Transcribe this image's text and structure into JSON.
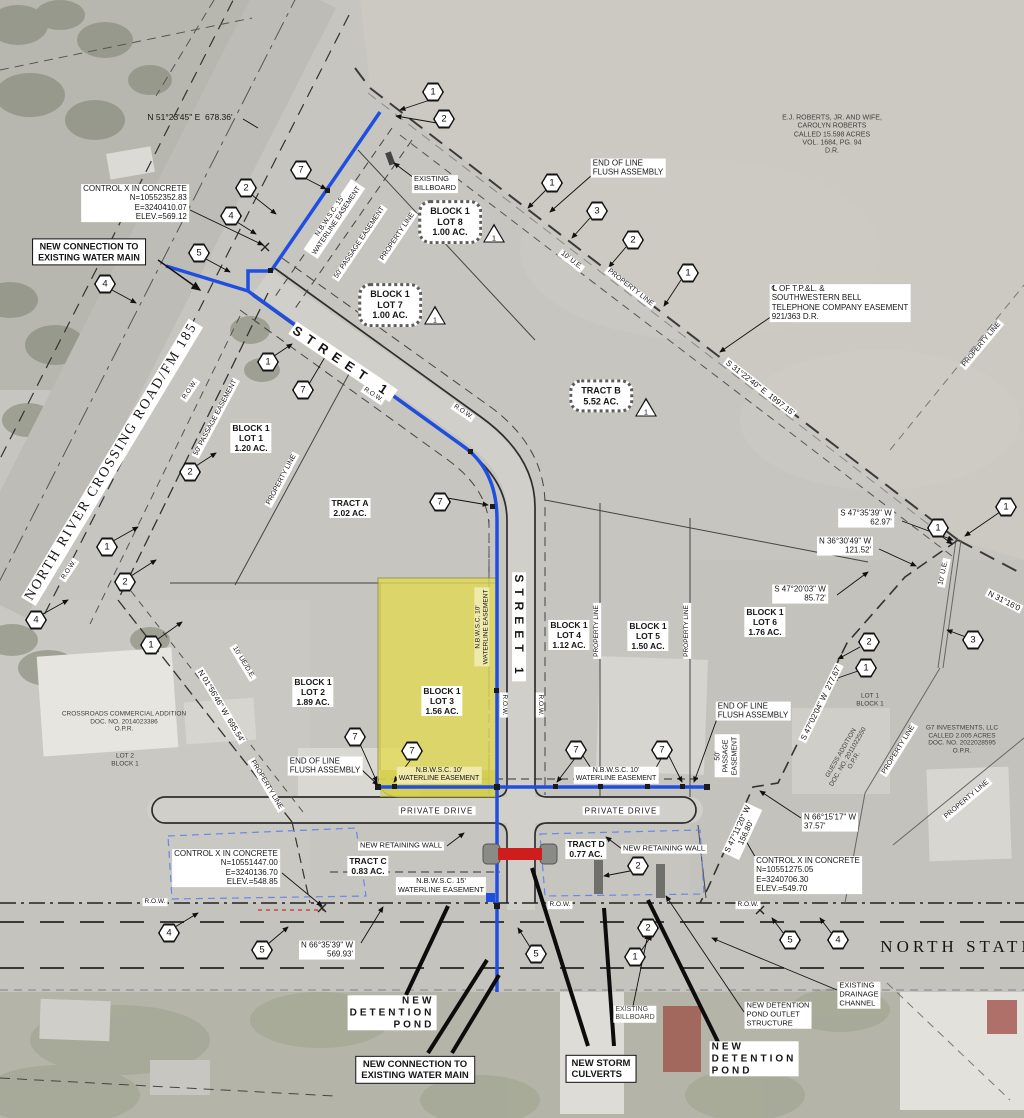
{
  "palette": {
    "waterline_blue": "#1f4fe0",
    "lot_highlight_yellow": "#e3dc52",
    "culvert_red": "#cf1d1d",
    "detention_outline_blue": "#6b86e8"
  },
  "labels": [
    {
      "id": "bearing-n512345",
      "text": "N 51°23'45\" E  678.36'",
      "x": 190,
      "y": 117,
      "fs": 8.5
    },
    {
      "id": "control-x-top",
      "text": "CONTROL X IN CONCRETE\nN=10552352.83\nE=3240410.07\nELEV.=569.12",
      "x": 135,
      "y": 203,
      "cls": "wbg",
      "fs": 8,
      "align": "right"
    },
    {
      "id": "new-connection-top",
      "text": "NEW CONNECTION TO\nEXISTING WATER MAIN",
      "x": 89,
      "y": 252,
      "cls": "boxed",
      "fs": 9
    },
    {
      "id": "nbwsc-15-easement-top",
      "text": "N.B.W.S.C. 15'\nWATERLINE EASEMENT",
      "x": 334,
      "y": 219,
      "rot": -56,
      "cls": "wbg",
      "fs": 7
    },
    {
      "id": "passage-easement-top",
      "text": "50' PASSAGE EASEMENT",
      "x": 360,
      "y": 243,
      "rot": -56,
      "cls": "wbg",
      "fs": 7
    },
    {
      "id": "property-line-top",
      "text": "PROPERTY LINE",
      "x": 398,
      "y": 237,
      "rot": -56,
      "cls": "wbg",
      "fs": 7
    },
    {
      "id": "existing-billboard-top",
      "text": "EXISTING\nBILLBOARD",
      "x": 435,
      "y": 184,
      "cls": "wbg",
      "fs": 7.5,
      "align": "left"
    },
    {
      "id": "end-of-line-top",
      "text": "END OF LINE\nFLUSH ASSEMBLY",
      "x": 628,
      "y": 168,
      "cls": "wbg",
      "fs": 8,
      "align": "left"
    },
    {
      "id": "block1-lot8",
      "text": "BLOCK 1\nLOT 8\n1.00 AC.",
      "x": 450,
      "y": 222,
      "cls": "cloud",
      "fs": 9
    },
    {
      "id": "block1-lot7",
      "text": "BLOCK 1\nLOT 7\n1.00 AC.",
      "x": 390,
      "y": 305,
      "cls": "cloud",
      "fs": 9
    },
    {
      "id": "ej-roberts-tract",
      "text": "E.J. ROBERTS, JR. AND WIFE,\nCAROLYN ROBERTS\nCALLED 15.598 ACRES\nVOL. 1684, PG. 94\nD.R.",
      "x": 832,
      "y": 135,
      "cls": "gray",
      "fs": 7
    },
    {
      "id": "tpl-bell-easement",
      "text": "℄ OF T.P.&L. &\nSOUTHWESTERN BELL\nTELEPHONE COMPANY EASEMENT\n921/363 D.R.",
      "x": 840,
      "y": 303,
      "cls": "wbg",
      "fs": 8,
      "align": "left"
    },
    {
      "id": "bearing-s312240",
      "text": "S 31°22'40\" E  1997.15'",
      "x": 760,
      "y": 388,
      "rot": 38,
      "cls": "wbg",
      "fs": 8
    },
    {
      "id": "ue-10-ne",
      "text": "10' U.E.",
      "x": 571,
      "y": 261,
      "rot": 38,
      "cls": "wbg",
      "fs": 7
    },
    {
      "id": "property-line-ne",
      "text": "PROPERTY LINE",
      "x": 630,
      "y": 288,
      "rot": 38,
      "cls": "wbg",
      "fs": 7
    },
    {
      "id": "tract-b",
      "text": "TRACT B\n5.52 AC.",
      "x": 601,
      "y": 396,
      "cls": "cloud",
      "fs": 9
    },
    {
      "id": "street-1-diagonal",
      "text": "STREET 1",
      "x": 343,
      "y": 362,
      "rot": 34,
      "cls": "wbg bold",
      "fs": 13,
      "ls": 7
    },
    {
      "id": "row-nrc-a",
      "text": "R.O.W.",
      "x": 190,
      "y": 390,
      "rot": -56,
      "cls": "wbg",
      "fs": 6.5
    },
    {
      "id": "row-street-a",
      "text": "R.O.W.",
      "x": 373,
      "y": 395,
      "rot": 34,
      "cls": "wbg",
      "fs": 6.5
    },
    {
      "id": "row-street-b",
      "text": "R.O.W.",
      "x": 463,
      "y": 412,
      "rot": 34,
      "cls": "wbg",
      "fs": 6.5
    },
    {
      "id": "property-line-lot1",
      "text": "PROPERTY LINE",
      "x": 282,
      "y": 480,
      "rot": -62,
      "cls": "wbg",
      "fs": 7
    },
    {
      "id": "passage-easement-lot1",
      "text": "50' PASSAGE EASEMENT",
      "x": 216,
      "y": 418,
      "rot": -62,
      "cls": "wbg",
      "fs": 7
    },
    {
      "id": "block1-lot1",
      "text": "BLOCK 1\nLOT 1\n1.20 AC.",
      "x": 251,
      "y": 438,
      "cls": "wbg bold",
      "fs": 8.5
    },
    {
      "id": "tract-a",
      "text": "TRACT A\n2.02 AC.",
      "x": 350,
      "y": 508,
      "cls": "wbg bold",
      "fs": 8.5
    },
    {
      "id": "bearing-s473539",
      "text": "S 47°35'39\" W\n62.97'",
      "x": 866,
      "y": 518,
      "cls": "wbg",
      "fs": 8,
      "align": "right"
    },
    {
      "id": "bearing-n363049",
      "text": "N 36°30'49\" W\n121.52'",
      "x": 845,
      "y": 546,
      "cls": "wbg",
      "fs": 8,
      "align": "right"
    },
    {
      "id": "bearing-s472003",
      "text": "S 47°20'03\" W\n85.72'",
      "x": 800,
      "y": 594,
      "cls": "wbg",
      "fs": 8,
      "align": "right"
    },
    {
      "id": "ue-10-right",
      "text": "10' U.E.",
      "x": 944,
      "y": 573,
      "rot": -78,
      "cls": "wbg",
      "fs": 7
    },
    {
      "id": "bearing-n31160",
      "text": "N 31°16'0",
      "x": 1004,
      "y": 601,
      "rot": 27,
      "cls": "wbg",
      "fs": 8
    },
    {
      "id": "property-line-right-top",
      "text": "PROPERTY LINE",
      "x": 982,
      "y": 345,
      "rot": -50,
      "cls": "wbg",
      "fs": 7
    },
    {
      "id": "row-nrc-b",
      "text": "R.O.W.",
      "x": 69,
      "y": 570,
      "rot": -56,
      "cls": "wbg",
      "fs": 6.5
    },
    {
      "id": "north-river-crossing-road",
      "text": "NORTH RIVER CROSSING ROAD/FM 185",
      "x": 112,
      "y": 462,
      "rot": -59,
      "cls": "wbg serif",
      "fs": 14,
      "ls": 2
    },
    {
      "id": "bearing-n015646",
      "text": "N 01°56'46\" W  695.54'",
      "x": 221,
      "y": 706,
      "rot": 59,
      "cls": "wbg",
      "fs": 8
    },
    {
      "id": "ue-de-10",
      "text": "10' UE/D.E.",
      "x": 243,
      "y": 663,
      "rot": 59,
      "cls": "wbg",
      "fs": 7
    },
    {
      "id": "property-line-sw",
      "text": "PROPERTY LINE",
      "x": 266,
      "y": 785,
      "rot": 59,
      "cls": "wbg",
      "fs": 7
    },
    {
      "id": "crossroads-addition",
      "text": "CROSSROADS COMMERCIAL ADDITION\nDOC. NO. 2014023386\nO.P.R.",
      "x": 124,
      "y": 722,
      "cls": "gray",
      "fs": 6.5
    },
    {
      "id": "lot2-block1-existing",
      "text": "LOT 2\nBLOCK 1",
      "x": 125,
      "y": 760,
      "cls": "gray",
      "fs": 6.5
    },
    {
      "id": "block1-lot2",
      "text": "BLOCK 1\nLOT 2\n1.89 AC.",
      "x": 313,
      "y": 692,
      "cls": "wbg bold",
      "fs": 8.5
    },
    {
      "id": "block1-lot3",
      "text": "BLOCK 1\nLOT 3\n1.56 AC.",
      "x": 442,
      "y": 701,
      "cls": "wbg bold",
      "fs": 8.5
    },
    {
      "id": "nbwsc-10-lot3-vert",
      "text": "N.B.W.S.C. 10'\nWATERLINE EASEMENT",
      "x": 482,
      "y": 627,
      "rot": -90,
      "cls": "pale",
      "fs": 6.5
    },
    {
      "id": "street-1-vertical",
      "text": "STREET 1",
      "x": 519,
      "y": 627,
      "rot": 90,
      "cls": "wbg bold",
      "fs": 12,
      "ls": 6
    },
    {
      "id": "row-street-v1",
      "text": "R.O.W.",
      "x": 504,
      "y": 705,
      "rot": 90,
      "cls": "wbg",
      "fs": 6.5
    },
    {
      "id": "row-street-v2",
      "text": "R.O.W.",
      "x": 540,
      "y": 705,
      "rot": 90,
      "cls": "wbg",
      "fs": 6.5
    },
    {
      "id": "block1-lot4",
      "text": "BLOCK 1\nLOT 4\n1.12 AC.",
      "x": 569,
      "y": 635,
      "cls": "wbg bold",
      "fs": 8.5
    },
    {
      "id": "property-line-v1",
      "text": "PROPERTY LINE",
      "x": 597,
      "y": 631,
      "rot": -90,
      "cls": "wbg",
      "fs": 6.5
    },
    {
      "id": "block1-lot5",
      "text": "BLOCK 1\nLOT 5\n1.50 AC.",
      "x": 648,
      "y": 636,
      "cls": "wbg bold",
      "fs": 8.5
    },
    {
      "id": "property-line-v2",
      "text": "PROPERTY LINE",
      "x": 687,
      "y": 631,
      "rot": -90,
      "cls": "wbg",
      "fs": 6.5
    },
    {
      "id": "block1-lot6",
      "text": "BLOCK 1\nLOT 6\n1.76 AC.",
      "x": 765,
      "y": 622,
      "cls": "wbg bold",
      "fs": 8.5
    },
    {
      "id": "bearing-s470204",
      "text": "S 47°02'04\" W  277.67'",
      "x": 821,
      "y": 703,
      "rot": -64,
      "cls": "wbg",
      "fs": 8
    },
    {
      "id": "lot1-block1-existing",
      "text": "LOT 1\nBLOCK 1",
      "x": 870,
      "y": 700,
      "cls": "gray",
      "fs": 6.5
    },
    {
      "id": "guess-addition",
      "text": "GUESS ADDITION\nDOC. NO. 2011022550\nO.P.R.",
      "x": 848,
      "y": 757,
      "rot": -60,
      "cls": "gray",
      "fs": 6.5
    },
    {
      "id": "property-line-guess",
      "text": "PROPERTY LINE",
      "x": 899,
      "y": 750,
      "rot": -58,
      "cls": "wbg",
      "fs": 7
    },
    {
      "id": "g7-investments",
      "text": "G7 INVESTMENTS, LLC\nCALLED 2.005 ACRES\nDOC. NO. 2022028595\nO.P.R.",
      "x": 962,
      "y": 740,
      "cls": "gray",
      "fs": 6.5
    },
    {
      "id": "property-line-g7",
      "text": "PROPERTY LINE",
      "x": 967,
      "y": 800,
      "rot": -40,
      "cls": "wbg",
      "fs": 7
    },
    {
      "id": "end-of-line-mid",
      "text": "END OF LINE\nFLUSH ASSEMBLY",
      "x": 753,
      "y": 711,
      "cls": "wbg",
      "fs": 8,
      "align": "left"
    },
    {
      "id": "passage-easement-50-vert",
      "text": "50'\nPASSAGE\nEASEMENT",
      "x": 727,
      "y": 756,
      "rot": -90,
      "cls": "wbg",
      "fs": 7
    },
    {
      "id": "end-of-line-left",
      "text": "END OF LINE\nFLUSH ASSEMBLY",
      "x": 325,
      "y": 766,
      "cls": "wbg",
      "fs": 8,
      "align": "left"
    },
    {
      "id": "nbwsc-10-left",
      "text": "N.B.W.S.C. 10'\nWATERLINE EASEMENT",
      "x": 439,
      "y": 775,
      "cls": "pale",
      "fs": 7
    },
    {
      "id": "nbwsc-10-right",
      "text": "N.B.W.S.C. 10'\nWATERLINE EASEMENT",
      "x": 616,
      "y": 775,
      "cls": "wbg",
      "fs": 7
    },
    {
      "id": "private-drive-left",
      "text": "PRIVATE DRIVE",
      "x": 437,
      "y": 811,
      "cls": "wbg",
      "fs": 8,
      "ls": 1
    },
    {
      "id": "private-drive-right",
      "text": "PRIVATE DRIVE",
      "x": 621,
      "y": 811,
      "cls": "wbg",
      "fs": 8,
      "ls": 1
    },
    {
      "id": "retaining-wall-left",
      "text": "NEW RETAINING WALL",
      "x": 401,
      "y": 846,
      "cls": "wbg",
      "fs": 7.5
    },
    {
      "id": "retaining-wall-right",
      "text": "NEW RETAINING WALL",
      "x": 664,
      "y": 849,
      "cls": "wbg",
      "fs": 7.5
    },
    {
      "id": "tract-c",
      "text": "TRACT C\n0.83 AC.",
      "x": 368,
      "y": 866,
      "cls": "wbg bold",
      "fs": 8.5
    },
    {
      "id": "tract-d",
      "text": "TRACT D\n0.77 AC.",
      "x": 586,
      "y": 849,
      "cls": "wbg bold",
      "fs": 8.5
    },
    {
      "id": "nbwsc-15-bottom",
      "text": "N.B.W.S.C. 15'\nWATERLINE EASEMENT",
      "x": 441,
      "y": 886,
      "cls": "wbg",
      "fs": 7.5
    },
    {
      "id": "control-x-bottom-left",
      "text": "CONTROL X IN CONCRETE\nN=10551447.00\nE=3240136.70\nELEV.=548.85",
      "x": 226,
      "y": 868,
      "cls": "wbg",
      "fs": 8,
      "align": "right"
    },
    {
      "id": "row-hwy-left",
      "text": "R.O.W.",
      "x": 155,
      "y": 902,
      "cls": "wbg",
      "fs": 6.5
    },
    {
      "id": "row-hwy-mid",
      "text": "R.O.W.",
      "x": 560,
      "y": 905,
      "cls": "wbg",
      "fs": 6.5
    },
    {
      "id": "row-hwy-right",
      "text": "R.O.W.",
      "x": 748,
      "y": 905,
      "cls": "wbg",
      "fs": 6.5
    },
    {
      "id": "bearing-n663539",
      "text": "N 66°35'39\" W\n569.93'",
      "x": 327,
      "y": 950,
      "cls": "wbg",
      "fs": 8,
      "align": "right"
    },
    {
      "id": "bearing-s471120",
      "text": "S 47°11'20\" W\n156.80'",
      "x": 742,
      "y": 831,
      "rot": -65,
      "cls": "wbg",
      "fs": 8
    },
    {
      "id": "bearing-n661517",
      "text": "N 66°15'17\" W\n37.57'",
      "x": 830,
      "y": 822,
      "cls": "wbg",
      "fs": 8,
      "align": "left"
    },
    {
      "id": "control-x-bottom-right",
      "text": "CONTROL X IN CONCRETE\nN=10551275.05\nE=3240706.30\nELEV.=549.70",
      "x": 808,
      "y": 875,
      "cls": "wbg",
      "fs": 8,
      "align": "left"
    },
    {
      "id": "north-state-road",
      "text": "NORTH STATE",
      "x": 958,
      "y": 947,
      "cls": "serif",
      "fs": 17,
      "ls": 4
    },
    {
      "id": "detention-pond-left",
      "text": "NEW\nDETENTION\nPOND",
      "x": 392,
      "y": 1013,
      "cls": "wbg bold",
      "fs": 10,
      "ls": 3,
      "align": "right"
    },
    {
      "id": "new-connection-bottom",
      "text": "NEW CONNECTION TO\nEXISTING WATER MAIN",
      "x": 415,
      "y": 1070,
      "cls": "boxed",
      "fs": 9.5
    },
    {
      "id": "new-storm-culverts",
      "text": "NEW STORM\nCULVERTS",
      "x": 601,
      "y": 1069,
      "cls": "boxed",
      "fs": 9.5,
      "align": "left"
    },
    {
      "id": "existing-billboard-bottom",
      "text": "EXISTING\nBILLBOARD",
      "x": 635,
      "y": 1014,
      "cls": "wbg gray",
      "fs": 7,
      "align": "left"
    },
    {
      "id": "detention-outlet",
      "text": "NEW DETENTION\nPOND OUTLET\nSTRUCTURE",
      "x": 778,
      "y": 1015,
      "cls": "wbg",
      "fs": 7.5,
      "align": "left"
    },
    {
      "id": "existing-drainage",
      "text": "EXISTING\nDRAINAGE\nCHANNEL",
      "x": 859,
      "y": 995,
      "cls": "wbg",
      "fs": 7.5,
      "align": "left"
    },
    {
      "id": "detention-pond-right",
      "text": "NEW\nDETENTION\nPOND",
      "x": 754,
      "y": 1059,
      "cls": "wbg bold",
      "fs": 10,
      "ls": 3,
      "align": "left"
    }
  ],
  "keynotes": [
    {
      "n": "1",
      "x": 433,
      "y": 92
    },
    {
      "n": "2",
      "x": 444,
      "y": 119
    },
    {
      "n": "7",
      "x": 301,
      "y": 170
    },
    {
      "n": "2",
      "x": 246,
      "y": 188
    },
    {
      "n": "4",
      "x": 231,
      "y": 216
    },
    {
      "n": "5",
      "x": 199,
      "y": 253
    },
    {
      "n": "4",
      "x": 105,
      "y": 284
    },
    {
      "n": "1",
      "x": 552,
      "y": 183
    },
    {
      "n": "3",
      "x": 597,
      "y": 211
    },
    {
      "n": "2",
      "x": 633,
      "y": 240
    },
    {
      "n": "1",
      "x": 688,
      "y": 273
    },
    {
      "n": "1",
      "x": 1006,
      "y": 507
    },
    {
      "n": "1",
      "x": 938,
      "y": 528
    },
    {
      "n": "3",
      "x": 973,
      "y": 640
    },
    {
      "n": "2",
      "x": 869,
      "y": 642
    },
    {
      "n": "1",
      "x": 866,
      "y": 668
    },
    {
      "n": "1",
      "x": 268,
      "y": 362
    },
    {
      "n": "7",
      "x": 303,
      "y": 390
    },
    {
      "n": "7",
      "x": 440,
      "y": 502
    },
    {
      "n": "2",
      "x": 190,
      "y": 472
    },
    {
      "n": "1",
      "x": 107,
      "y": 547
    },
    {
      "n": "2",
      "x": 125,
      "y": 582
    },
    {
      "n": "4",
      "x": 36,
      "y": 620
    },
    {
      "n": "1",
      "x": 151,
      "y": 645
    },
    {
      "n": "7",
      "x": 355,
      "y": 737
    },
    {
      "n": "7",
      "x": 412,
      "y": 751
    },
    {
      "n": "7",
      "x": 576,
      "y": 750
    },
    {
      "n": "7",
      "x": 662,
      "y": 750
    },
    {
      "n": "2",
      "x": 638,
      "y": 866
    },
    {
      "n": "4",
      "x": 169,
      "y": 933
    },
    {
      "n": "5",
      "x": 262,
      "y": 950
    },
    {
      "n": "5",
      "x": 536,
      "y": 954
    },
    {
      "n": "1",
      "x": 635,
      "y": 957
    },
    {
      "n": "2",
      "x": 648,
      "y": 928
    },
    {
      "n": "5",
      "x": 790,
      "y": 940
    },
    {
      "n": "4",
      "x": 838,
      "y": 940
    }
  ],
  "triangles": [
    {
      "n": "1",
      "x": 494,
      "y": 233
    },
    {
      "n": "1",
      "x": 435,
      "y": 315
    },
    {
      "n": "1",
      "x": 646,
      "y": 407
    }
  ]
}
